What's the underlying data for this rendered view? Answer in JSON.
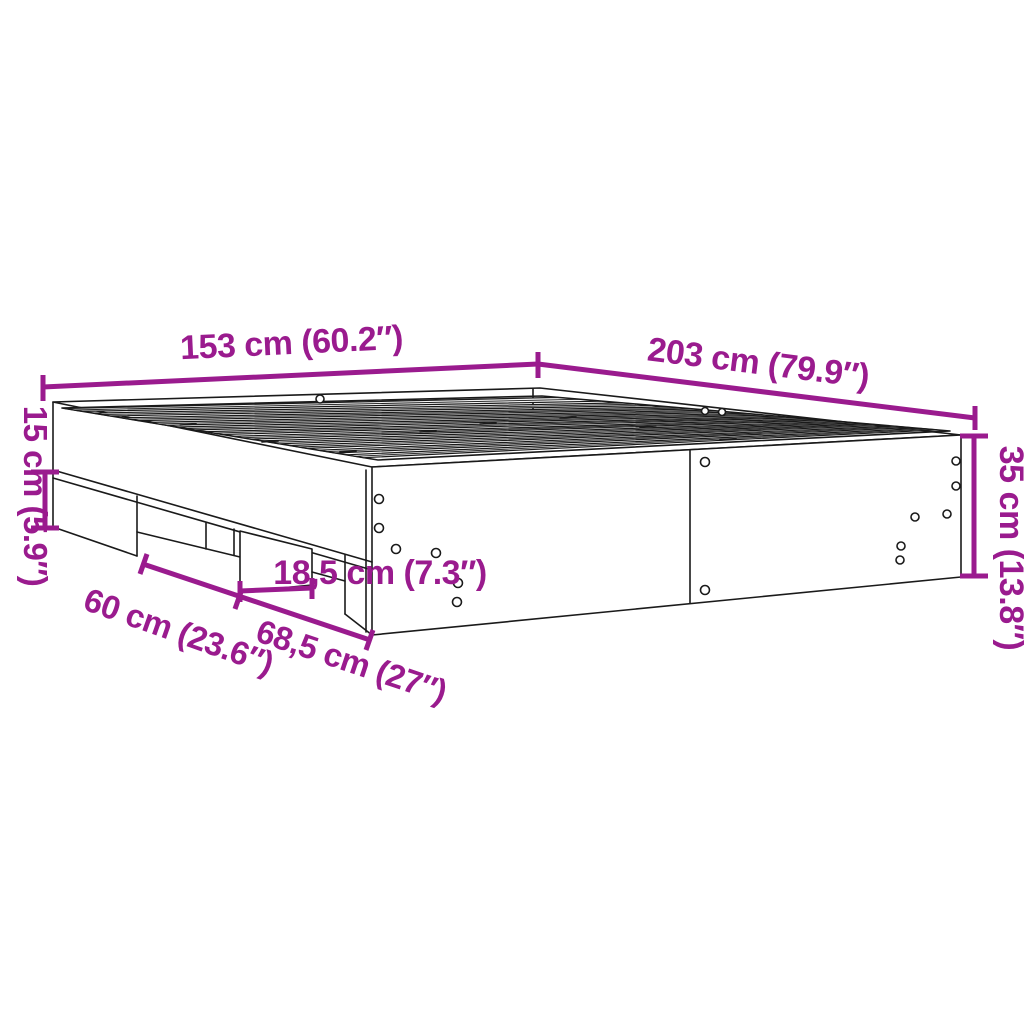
{
  "page": {
    "background": "#ffffff"
  },
  "diagram": {
    "subject": "bed-frame-dimension-drawing",
    "accent_color": "#9A1B8E",
    "line_color": "#1a1a1a",
    "dims": {
      "width": "153 cm (60.2″)",
      "length": "203 cm (79.9″)",
      "height": "35 cm (13.8″)",
      "side_rail_height": "15 cm (5.9″)",
      "foot_width": "18,5 cm (7.3″)",
      "foot_gap_left": "60 cm (23.6″)",
      "foot_gap_right": "68,5 cm (27″)"
    }
  }
}
